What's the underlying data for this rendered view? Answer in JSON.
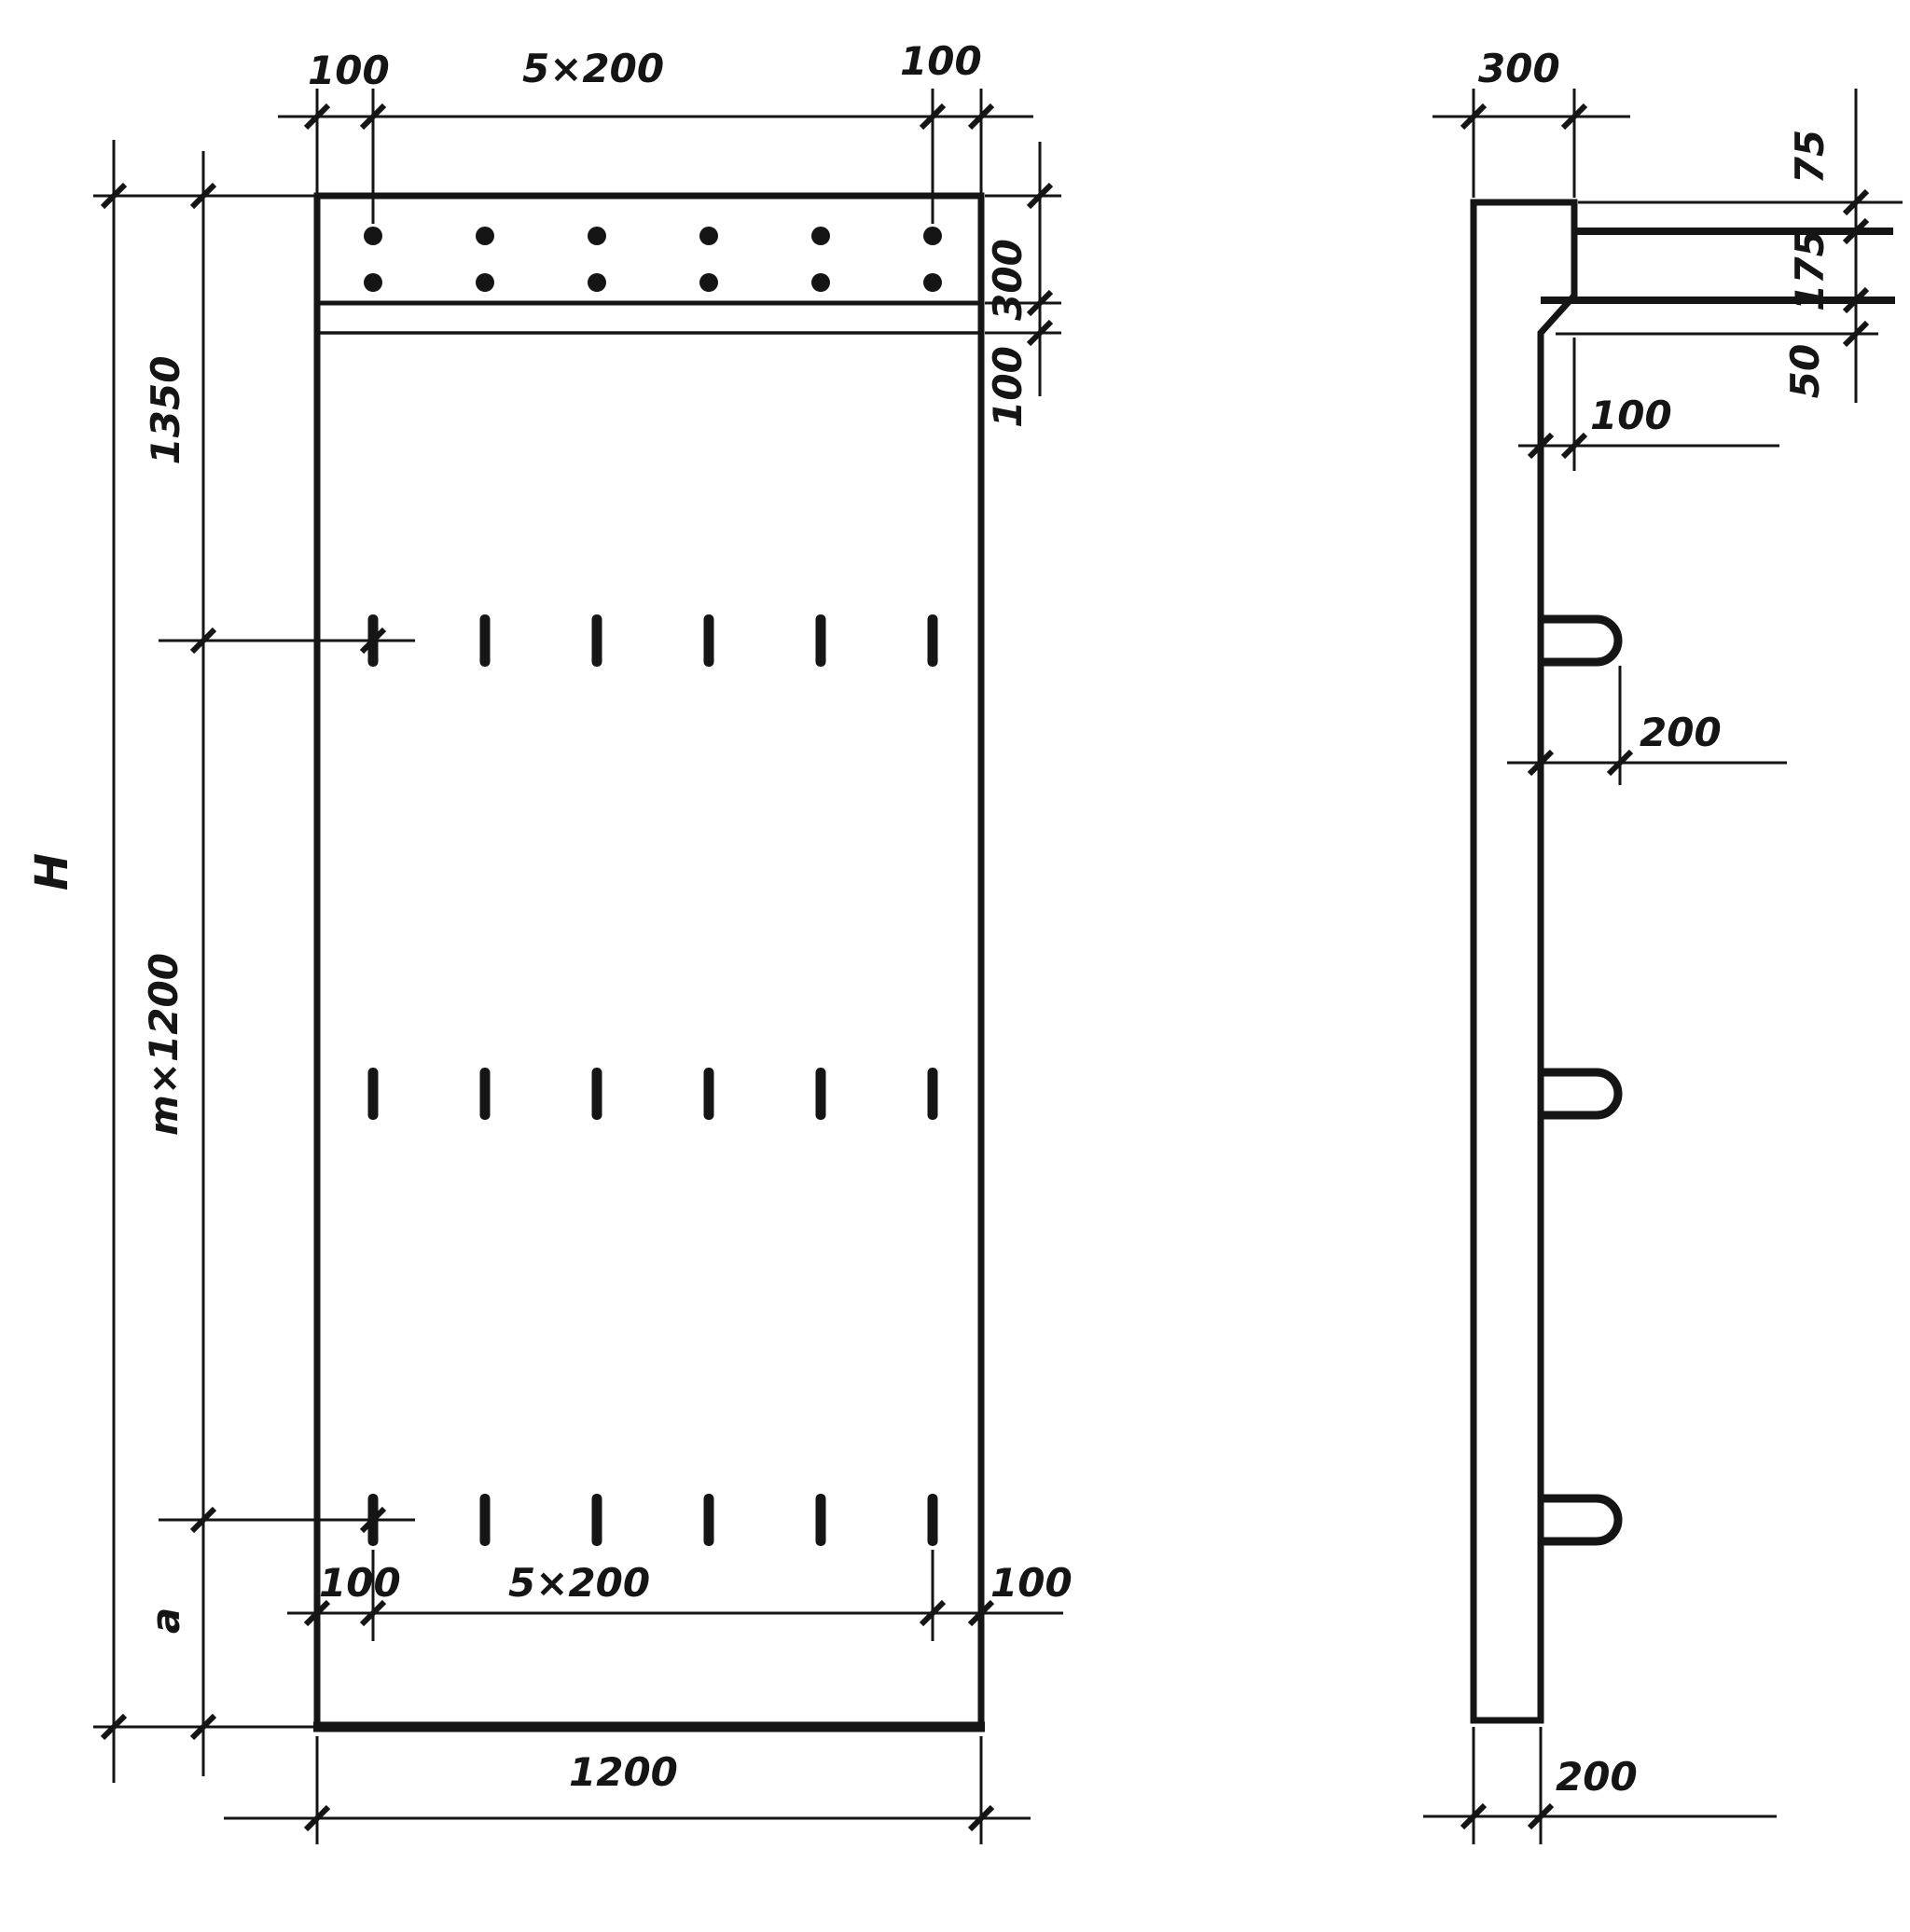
{
  "drawing": {
    "front_view": {
      "top_dims": {
        "left_margin": "100",
        "spacing": "5×200",
        "right_margin": "100"
      },
      "right_dims": {
        "band_height": "300",
        "band_gap": "100"
      },
      "left_dims": {
        "overall_height": "H",
        "top_segment": "1350",
        "middle_segment": "m×1200",
        "bottom_segment": "a"
      },
      "bottom_dims": {
        "left_margin": "100",
        "spacing": "5×200",
        "right_margin": "100",
        "overall_width": "1200"
      },
      "hole_grid": {
        "rows": 2,
        "columns": 6
      },
      "slot_rows": {
        "count": 3,
        "slots_per_row": 6
      }
    },
    "side_view": {
      "top_width": "300",
      "right_dims": {
        "d1": "75",
        "d2": "175",
        "d3": "50"
      },
      "step_offset": "100",
      "loop_length": "200",
      "bottom_thickness": "200",
      "loops": {
        "count": 3
      }
    }
  }
}
